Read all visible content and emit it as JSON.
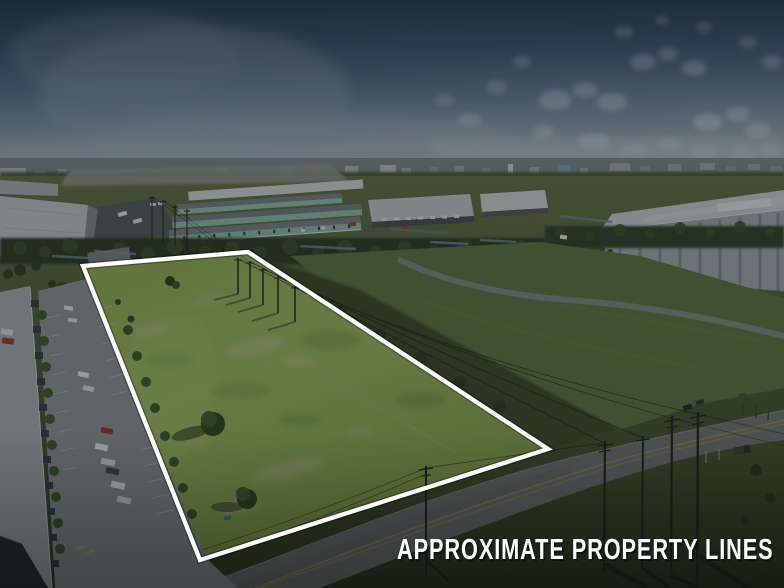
{
  "caption": {
    "text": "APPROXIMATE PROPERTY LINES",
    "color": "#ffffff"
  },
  "annotation": {
    "outline_color": "#ffffff",
    "outline_points": "83,266 248,252 548,449 200,560"
  },
  "overlay": {
    "dim_color": "#0a0e13",
    "dim_opacity": "0.32"
  }
}
